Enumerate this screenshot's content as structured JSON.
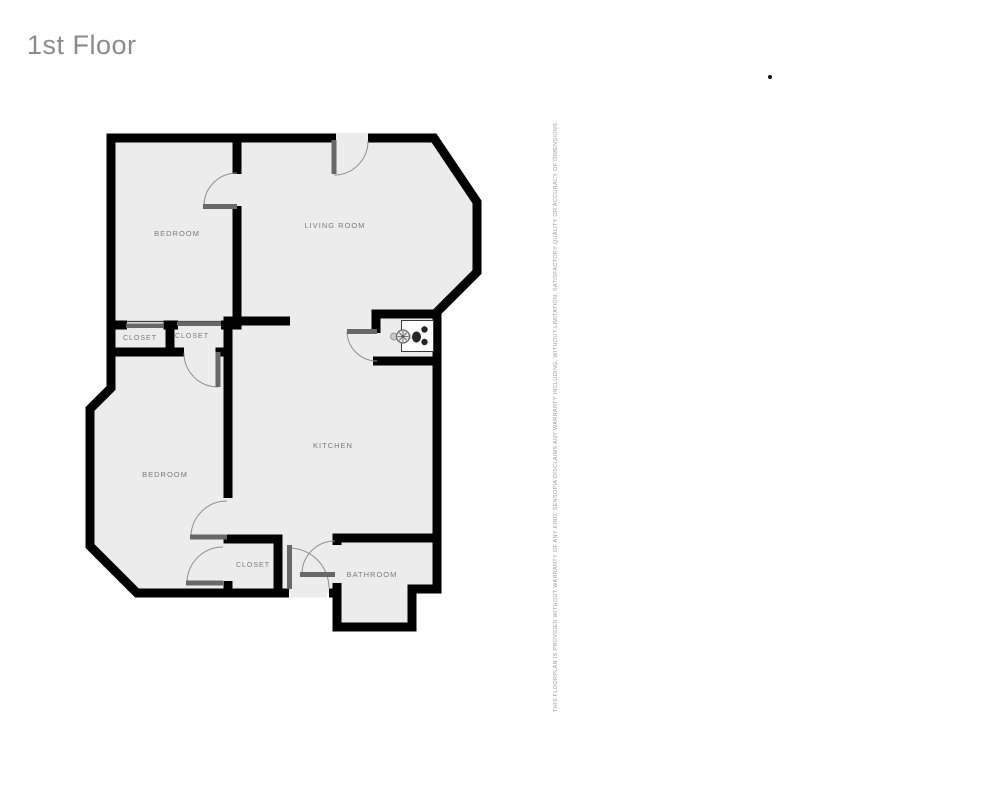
{
  "header": {
    "title": "1st Floor"
  },
  "disclaimer": {
    "text": "THIS FLOORPLAN IS PROVIDED WITHOUT WARRANTY OF ANY KIND. SENSOPIA DISCLAIMS ANY WARRANTY INCLUDING, WITHOUT LIMITATION, SATISFACTORY QUALITY OR ACCURACY OF DIMENSIONS."
  },
  "floorplan": {
    "rooms": [
      {
        "id": "bedroom-1",
        "label": "BEDROOM"
      },
      {
        "id": "living-room",
        "label": "LIVING ROOM"
      },
      {
        "id": "closet-1",
        "label": "CLOSET"
      },
      {
        "id": "closet-2",
        "label": "CLOSET"
      },
      {
        "id": "closet-alcove",
        "label": "CLOSET"
      },
      {
        "id": "bedroom-2",
        "label": "BEDROOM"
      },
      {
        "id": "kitchen",
        "label": "KITCHEN"
      },
      {
        "id": "closet-3",
        "label": "CLOSET"
      },
      {
        "id": "bathroom",
        "label": "BATHROOM"
      }
    ],
    "fixtures": [
      {
        "name": "stove",
        "location": "kitchen-alcove"
      }
    ],
    "colors": {
      "wall": "#000000",
      "floor": "#ececec",
      "door_leaf": "#686868",
      "door_arc": "#8f8f8f",
      "label": "#7a7a7a",
      "title": "#8b8b8b",
      "disclaimer": "#999999"
    }
  }
}
